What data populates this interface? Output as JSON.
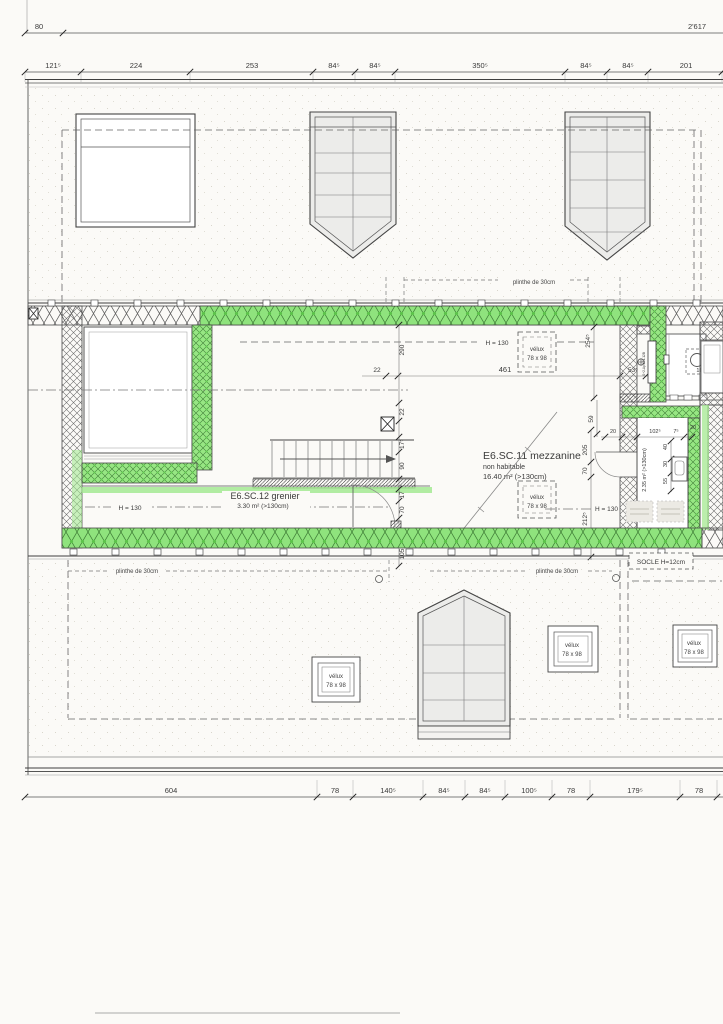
{
  "drawing": {
    "type": "attic floor plan (scanned architectural drawing)",
    "highlight_color": "#8fe37d",
    "paper_color": "#fbfaf7"
  },
  "dims": {
    "overall": "2'617",
    "offset": "80",
    "top": [
      "121⁵",
      "224",
      "253",
      "84⁵",
      "84⁵",
      "350⁵",
      "84⁵",
      "84⁵",
      "201"
    ],
    "bottom": [
      "604",
      "78",
      "140⁵",
      "84⁵",
      "84⁵",
      "100⁵",
      "78",
      "179⁵",
      "78"
    ],
    "h22": "22",
    "h461": "461",
    "h53": "53⁵",
    "h18": "18",
    "v290": "290",
    "v22": "22",
    "v17a": "17⁵",
    "v90": "90",
    "v17b": "17",
    "v70": "70",
    "v105": "105",
    "v254": "254⁵",
    "v59": "59",
    "v205": "205",
    "v70b": "70",
    "v212": "212⁵",
    "c20a": "20",
    "c102": "102⁵",
    "c7": "7⁵",
    "c20b": "20",
    "c40": "40",
    "c30": "30",
    "c55": "55",
    "round_window": "160"
  },
  "rooms": {
    "mezzanine": {
      "name": "E6.SC.11 mezzanine",
      "note": "non habitable",
      "area": "16.40 m² (>130cm)"
    },
    "grenier": {
      "name": "E6.SC.12 grenier",
      "area": "3.30 m² (>130cm)"
    },
    "cabinet": {
      "area": "2.35 m² (>130cm)",
      "ref": "S+2-Ap-171-12B"
    }
  },
  "labels": {
    "height_line": "H = 130",
    "velux": "vélux",
    "velux_size": "78 x 98",
    "plinthe": "plinthe de 30cm",
    "socle": "SOCLE H=12cm"
  }
}
